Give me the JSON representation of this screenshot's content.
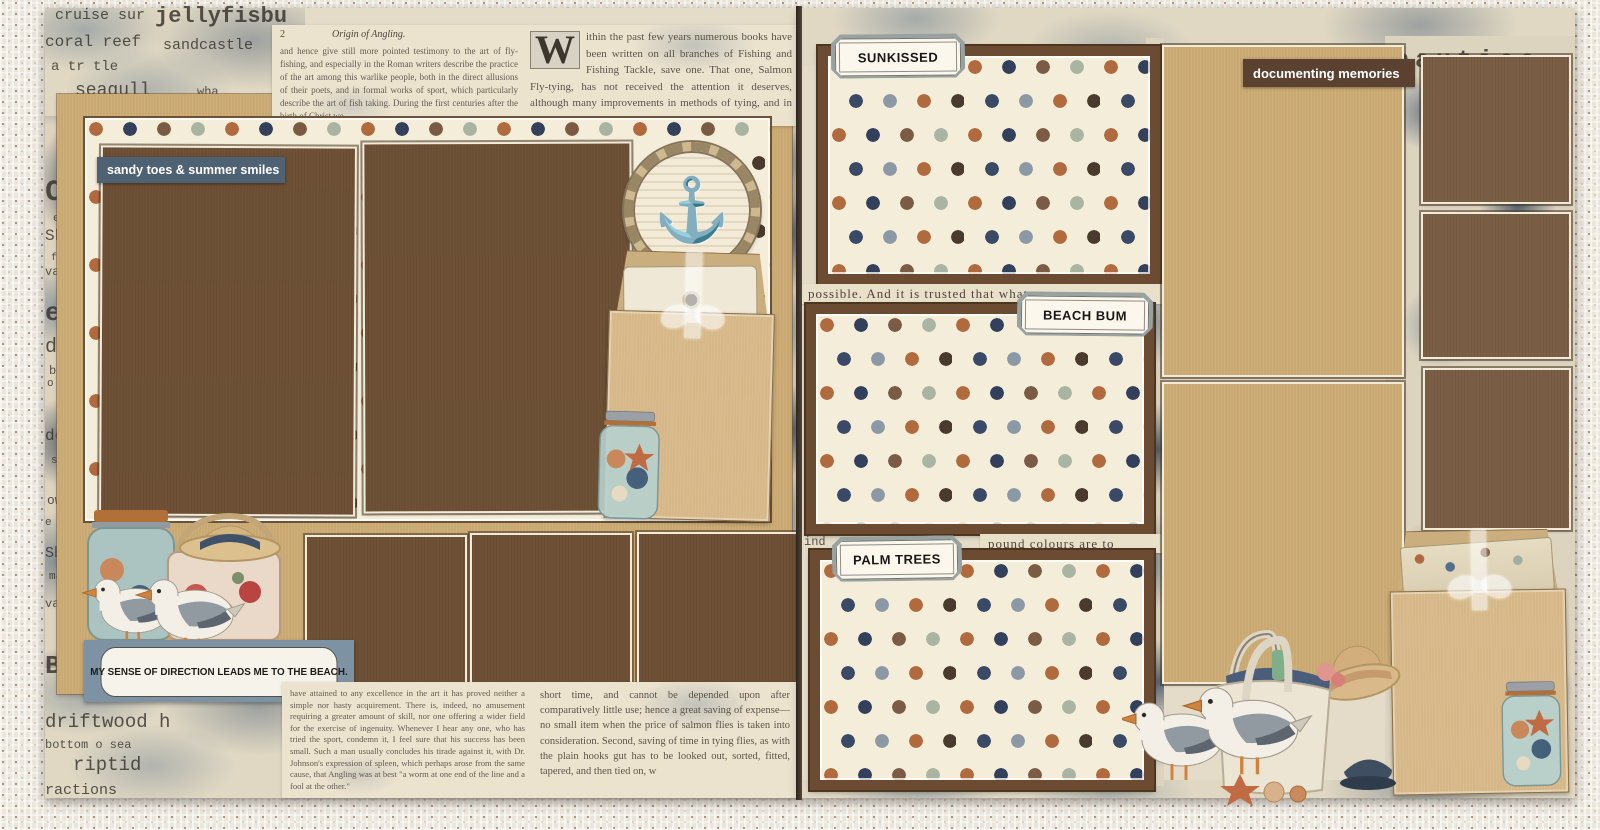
{
  "labels": {
    "sandy_toes": "sandy toes & summer smiles",
    "direction_sentiment": "MY SENSE OF DIRECTION LEADS ME TO THE BEACH.",
    "sunkissed": "SUNKISSED",
    "beach_bum": "BEACH BUM",
    "palm_trees": "PALM TREES",
    "documenting_memories": "documenting memories"
  },
  "scatter": {
    "left": [
      "cruise sur",
      "jellyfisbu",
      "coral reef",
      "sandcastle",
      "a tr tle",
      "seagull",
      "wha",
      "Coa",
      "ep ble",
      "Shipw",
      "fla g a",
      "vacation",
      "san",
      "ea",
      "drift",
      "bott",
      "o sea",
      "der",
      "si",
      "ow",
      "e blue",
      "Ship",
      "ma",
      "vacation",
      "sandy",
      "Beach",
      "dee",
      "driftwood h",
      "bottom o sea",
      "riptid",
      "ractions"
    ],
    "right": [
      "jellyfish sun nautica",
      "clownfish",
      "wharf"
    ]
  },
  "strips": {
    "one": "possible.   And it is trusted that what",
    "two_prefix": "ind",
    "two": "pound colours are to"
  },
  "book": {
    "page_no": "2",
    "heading": "Origin of Angling.",
    "top_left": "and hence give still more pointed testimony to the art of fly-fishing, and especially in the Roman writers describe the practice of the art among this warlike people, both in the direct allusions of their poets, and in formal works of sport, which particularly describe the art of fish taking. During the first centuries after the birth of Christ we",
    "dropcap": "W",
    "top_right": "ithin the past few years numerous books have been written on all branches of Fishing and Fishing Tackle, save one. That one, Salmon Fly-tying, has not received the attention it deserves, although many improvements in methods of tying, and in materials used,",
    "bottom_left": "have attained to any excellence in the art it has proved neither a simple nor hasty acquirement. There is, indeed, no amusement requiring a greater amount of skill, nor one offering a wider field for the exercise of ingenuity. Whenever I hear any one, who has tried the sport, condemn it, I feel sure that his success has been small. Such a man usually concludes his tirade against it, with Dr. Johnson's expression of spleen, which perhaps arose from the same cause, that Angling was at best \"a worm at one end of the line and a fool at the other.\"",
    "bottom_right": "short time, and cannot be depended upon after comparatively little use; hence a great saving of expense—no small item when the price of salmon flies is taken into consideration.  Second, saving of time in tying flies, as with the plain hooks gut has to be looked out, sorted, fitted, tapered, and then tied on, w"
  },
  "icons": {
    "anchor": "⚓"
  },
  "colors": {
    "tan_cardstock": "#c9a871",
    "chocolate_mat": "#6e5136",
    "brown_mat_right": "#7a5f45",
    "dot_cream": "#f4edda",
    "dot_navy": "#32405c",
    "dot_rust": "#b06a3d",
    "dot_brown": "#7c5b44",
    "dot_sage": "#a9b5a2",
    "slate_label": "#4e6273",
    "brown_label": "#5a4130",
    "plaque_frame": "#98a3a1",
    "sentiment_frame": "#7d93a4",
    "kraft_envelope": "#d6b888"
  }
}
